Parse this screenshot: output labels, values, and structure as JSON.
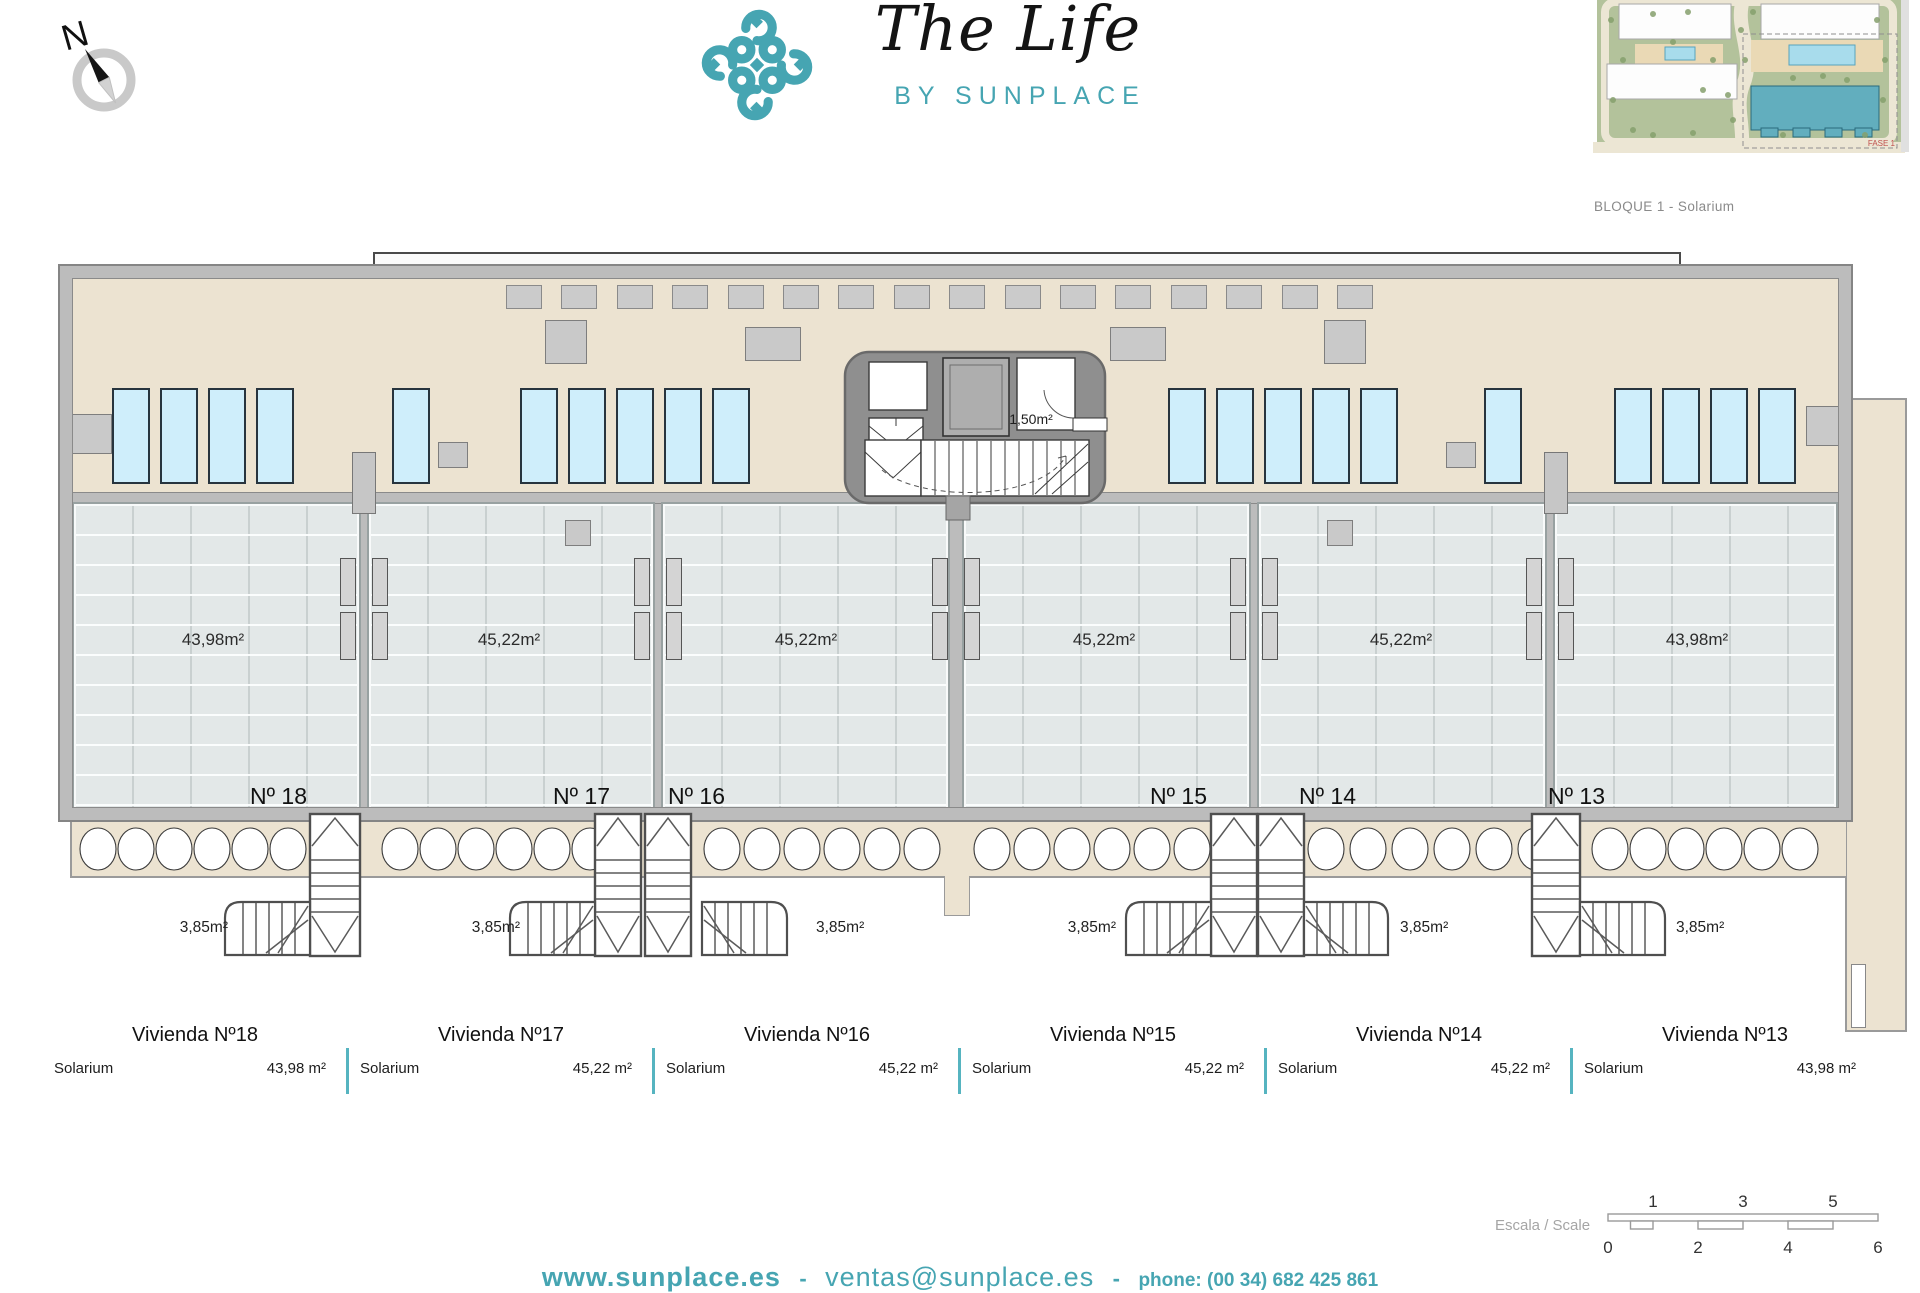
{
  "header": {
    "compass_label": "N",
    "logo": {
      "title": "The Life",
      "subtitle": "BY SUNPLACE"
    },
    "site_plan": {
      "caption": "BLOQUE 1 - Solarium",
      "phase_label": "FASE 1"
    }
  },
  "plan": {
    "core_room_area": "1,50m²",
    "units": [
      {
        "number": "Nº 18",
        "area": "43,98m²",
        "stair_area": "3,85m²"
      },
      {
        "number": "Nº 17",
        "area": "45,22m²",
        "stair_area": "3,85m²"
      },
      {
        "number": "Nº 16",
        "area": "45,22m²",
        "stair_area": "3,85m²"
      },
      {
        "number": "Nº 15",
        "area": "45,22m²",
        "stair_area": "3,85m²"
      },
      {
        "number": "Nº 14",
        "area": "45,22m²",
        "stair_area": "3,85m²"
      },
      {
        "number": "Nº 13",
        "area": "43,98m²",
        "stair_area": "3,85m²"
      }
    ]
  },
  "legend": {
    "entries": [
      {
        "title": "Vivienda Nº18",
        "room": "Solarium",
        "area": "43,98 m²"
      },
      {
        "title": "Vivienda Nº17",
        "room": "Solarium",
        "area": "45,22 m²"
      },
      {
        "title": "Vivienda Nº16",
        "room": "Solarium",
        "area": "45,22 m²"
      },
      {
        "title": "Vivienda Nº15",
        "room": "Solarium",
        "area": "45,22 m²"
      },
      {
        "title": "Vivienda Nº14",
        "room": "Solarium",
        "area": "45,22 m²"
      },
      {
        "title": "Vivienda Nº13",
        "room": "Solarium",
        "area": "43,98 m²"
      }
    ]
  },
  "scale_bar": {
    "label": "Escala / Scale",
    "ticks_top": [
      "1",
      "3",
      "5"
    ],
    "ticks_bottom": [
      "0",
      "2",
      "4",
      "6"
    ]
  },
  "footer": {
    "website": "www.sunplace.es",
    "sep1": "-",
    "email": "ventas@sunplace.es",
    "sep2": "-",
    "phone": "phone: (00 34) 682 425 861"
  },
  "colors": {
    "accent": "#46a5b2",
    "legend_divider": "#56b4c0",
    "lounger": "#cfeefb",
    "terrace": "#ece3d1",
    "tile": "#e3e8e8",
    "wall": "#bcbcbc",
    "highlight_building": "#62aebe"
  }
}
